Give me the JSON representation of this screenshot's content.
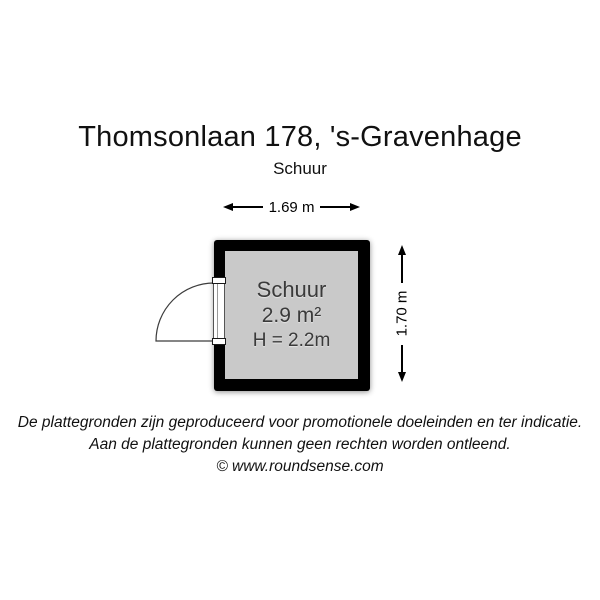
{
  "header": {
    "title": "Thomsonlaan 178, 's-Gravenhage",
    "subtitle": "Schuur"
  },
  "floorplan": {
    "room": {
      "name": "Schuur",
      "area": "2.9 m²",
      "ceiling_height": "H = 2.2m"
    },
    "dimensions": {
      "width_label": "1.69 m",
      "height_label": "1.70 m"
    },
    "colors": {
      "wall": "#000000",
      "floor": "#c9c9c9",
      "room_text": "#3a3a3a",
      "dimension_lines": "#000000"
    }
  },
  "footer": {
    "disclaimer_line1": "De plattegronden zijn geproduceerd voor promotionele doeleinden en ter indicatie.",
    "disclaimer_line2": "Aan de plattegronden kunnen geen rechten worden ontleend.",
    "copyright": "© www.roundsense.com"
  }
}
